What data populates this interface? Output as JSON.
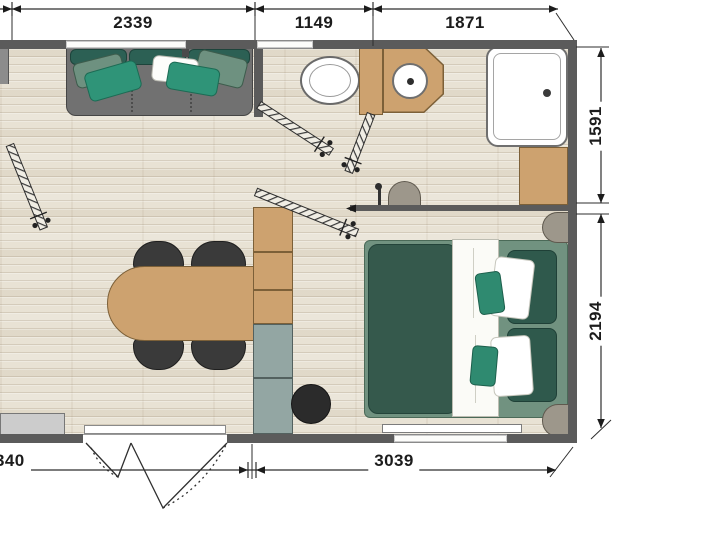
{
  "document": {
    "type": "floor-plan",
    "units": "mm"
  },
  "dimensions": {
    "top": [
      {
        "label": "2339"
      },
      {
        "label": "1149"
      },
      {
        "label": "1871"
      }
    ],
    "right": [
      {
        "label": "1591"
      },
      {
        "label": "2194"
      }
    ],
    "bottom": [
      {
        "label": "340"
      },
      {
        "label": "3039"
      }
    ]
  },
  "palette": {
    "wall": "#5b5b5b",
    "floor_wood": "#e8e2d4",
    "cabinet_wood": "#cda26f",
    "cabinet_slate": "#93a6a3",
    "sofa_gray": "#717171",
    "green_dark": "#35594c",
    "green_mid": "#719280",
    "teal_accent": "#2f9478",
    "sage": "#6e9180",
    "black_furniture": "#2d2d2d",
    "nightstand_gray": "#9d978b"
  },
  "furniture": [
    "sofa",
    "dining-table",
    "dining-chairs",
    "tall-cabinet-column",
    "stool",
    "doormat",
    "toilet",
    "washbasin",
    "shower",
    "bathroom-cabinet",
    "pouf",
    "double-bed",
    "nightstands",
    "radiator",
    "entrance-double-door",
    "open-door-leaves"
  ]
}
